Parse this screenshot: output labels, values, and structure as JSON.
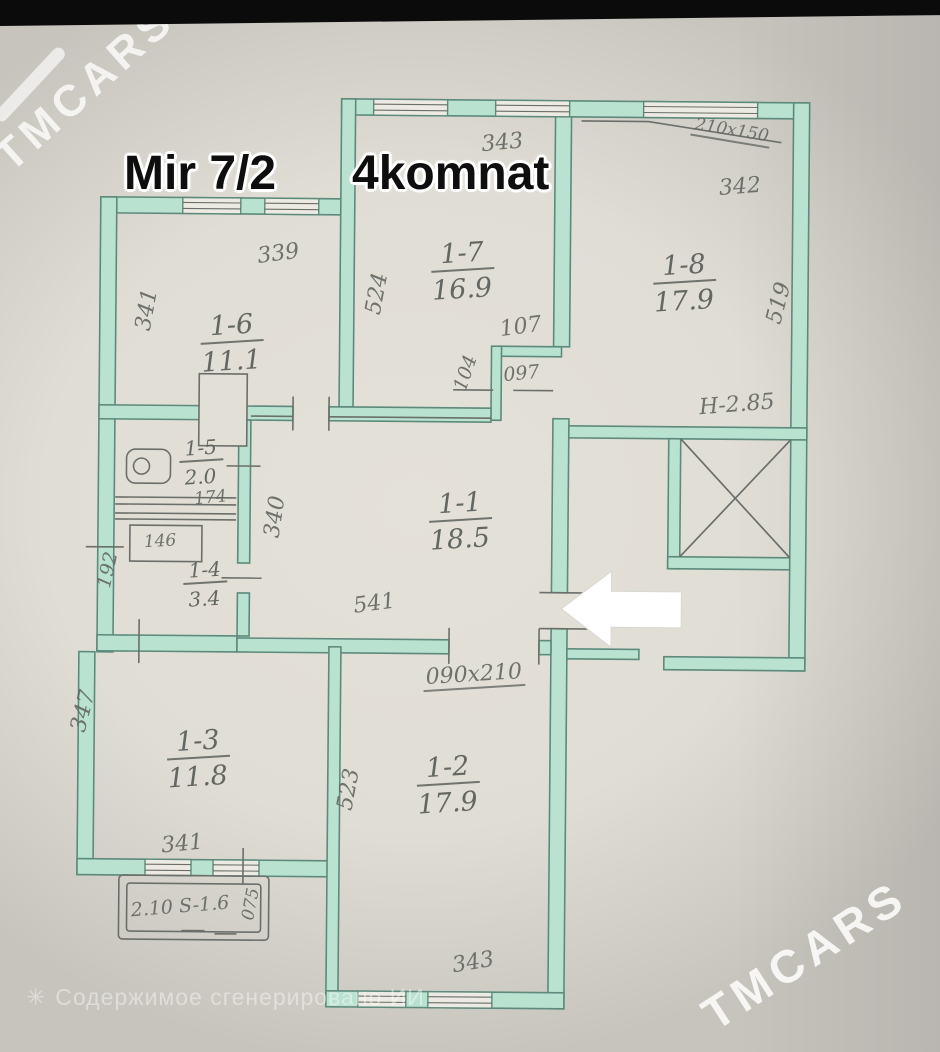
{
  "photo": {
    "watermark_top_left": "TMCARS",
    "watermark_bottom_right": "TMCARS",
    "ai_caption": "Содержимое сгенерировано ИИ",
    "ai_caption_icon": "sparkle-icon"
  },
  "title": {
    "address": "Mir 7/2",
    "layout": "4komnat"
  },
  "plan": {
    "rooms": {
      "r11": {
        "number": "1-1",
        "area": "18.5"
      },
      "r12": {
        "number": "1-2",
        "area": "17.9"
      },
      "r13": {
        "number": "1-3",
        "area": "11.8"
      },
      "r14": {
        "number": "1-4",
        "area": "3.4"
      },
      "r15": {
        "number": "1-5",
        "area": "2.0"
      },
      "r16": {
        "number": "1-6",
        "area": "11.1"
      },
      "r17": {
        "number": "1-7",
        "area": "16.9"
      },
      "r18": {
        "number": "1-8",
        "area": "17.9"
      }
    },
    "dims": {
      "r17_width": "343",
      "r18_label": "342",
      "r17_left": "524",
      "r18_right": "519",
      "r16_width": "339",
      "r16_left": "341",
      "hall_107": "107",
      "hall_104": "104",
      "door_097": "097",
      "window_210x150": "210x150",
      "height_note": "H-2.85",
      "hall_340": "340",
      "door_174": "174",
      "box_146": "146",
      "hall_192": "192",
      "r11_width": "541",
      "door_090x210": "090x210",
      "r13_left": "347",
      "r13_width": "341",
      "r12_left": "523",
      "r12_width": "343",
      "balcony_label": "2.10 S-1.6",
      "balcony_depth": "075"
    }
  }
}
